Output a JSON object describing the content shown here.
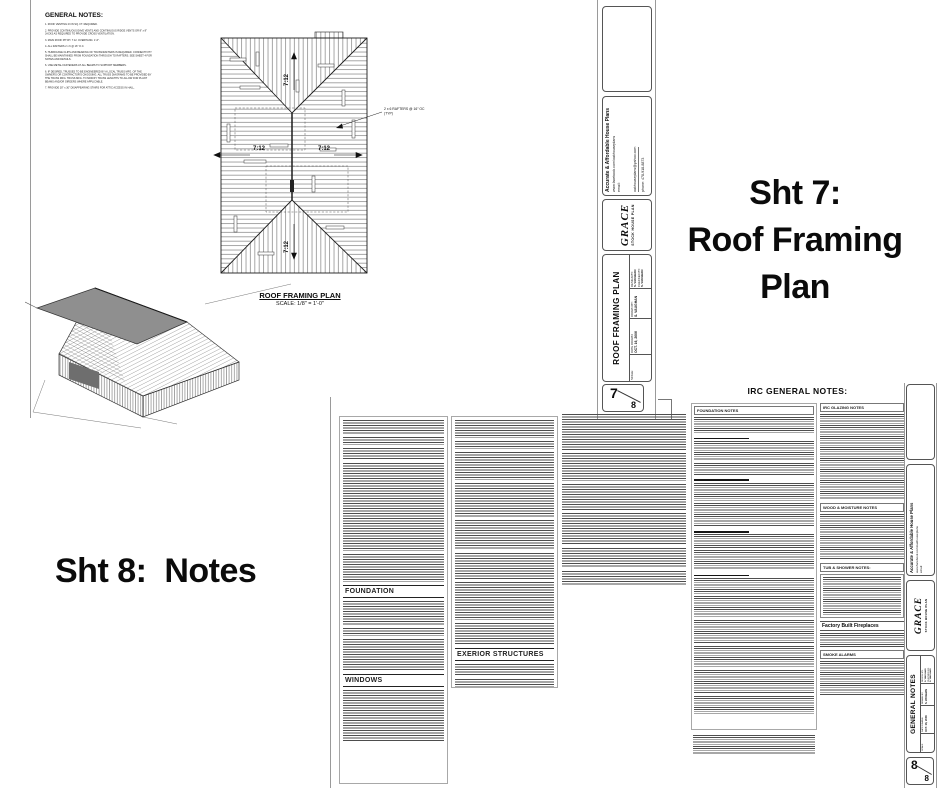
{
  "colors": {
    "ink": "#111111",
    "text_gray": "#4d4d4d",
    "border_gray": "#9a9a9a"
  },
  "annotations": {
    "sheet7_line1": "Sht 7:",
    "sheet7_line2": "Roof Framing",
    "sheet7_line3": "Plan",
    "sheet8_text": "Sht 8:  Notes"
  },
  "sheet7": {
    "general_notes": {
      "title": "GENERAL NOTES:",
      "items": [
        "1. ROOF VENTING 23 IN SQ. FT. REQUIRED.",
        "2. PROVIDE CONTINUOUS EAVE VENTS AND CONTINUOUS RIDGE VENTS OR 8\" x 8\" JACKS AS REQUIRED TO PROVIDE CROSS VENTILATION.",
        "3. MAIN ROOF PITCH: 7:12.   OVERHANG: 1'-6\".",
        "4. ALL RAFTERS 2 x 6 @ 16\" O.C.",
        "5. HURRICANE CLIPS AND BEARING OF TRUSS/RAFTERS IS REQUIRED.  CONNECTIVITY SHALL BE MAINTAINED FROM FOUNDATION THROUGH TO RAFTERS.  SEE SHEET 4 FOR NOTES AND DETAILS.",
        "6. USE METAL FASTENERS AT ALL BEAMS TO SUPPORT MEMBERS.",
        "6. IF DESIRED, TRUSSES TO BE ENGINEERED BY A LOCAL TRUSS MFG. OF THE OWNER'S OR CONTRACTOR'S CHOOSING.  ALL TRUSS DIAGRAMS TO BE PROVIDED BY THE TRUSS MFG.  TRUSS MFG. TO MODIFY TRUSS LENGTHS TO ALLOW FOR PLANT BEAMS AND/OR GIRDERS WHERE APPLICABLE.",
        "7. PROVIDE 30\" x 30\" DISAPPEARING STAIRS FOR ATTIC ACCESS IN HALL."
      ]
    },
    "plan": {
      "title": "ROOF FRAMING PLAN",
      "scale": "SCALE:  1/8\" = 1'-0\"",
      "pitch": "7:12",
      "callout1": "2 x 6 RAFTERS @ 16\" OC",
      "callout2": "(TYP)"
    }
  },
  "sheet8": {
    "foundation_header": "FOUNDATION",
    "windows_header": "WINDOWS",
    "exterior_header": "EXERIOR STRUCTURES",
    "irc_title": "IRC GENERAL NOTES:",
    "irc_foundation": "FOUNDATION NOTES",
    "irc_glazing": "IRC GLAZING NOTES",
    "irc_wood": "WOOD & MOISTURE NOTES",
    "irc_tub": "TUB & SHOWER NOTES:",
    "irc_fireplace": "Factory Built Fireplaces",
    "irc_smoke": "SMOKE ALARMS"
  },
  "titleblock": {
    "company": "Accurate & Affordable House Plans",
    "facebook": "www.facebook.com/oakhouseplans",
    "email_label": "email:",
    "email": "oakhouseplans@yahoo.com",
    "phone": "phone:  478-918-8873",
    "brand": "GRACE",
    "brand_sub": "STOCK HOUSE PLAN",
    "scale_label": "SCALE:",
    "date_label": "DATE DRAWN:",
    "date": "OCT. 16, 2006",
    "drawn_label": "DRAWN BY:",
    "drawn": "S. VAUGHAN",
    "design_label": "DESIGN BY:",
    "design": "S. VAUGHAN",
    "checked_label": "CHECKED BY:",
    "checked": "S. VAUGHAN",
    "sheet7_title": "ROOF FRAMING PLAN",
    "sheet8_title": "GENERAL NOTES",
    "sheet7_num": "7",
    "sheet8_num": "8",
    "sheet_total": "8"
  }
}
